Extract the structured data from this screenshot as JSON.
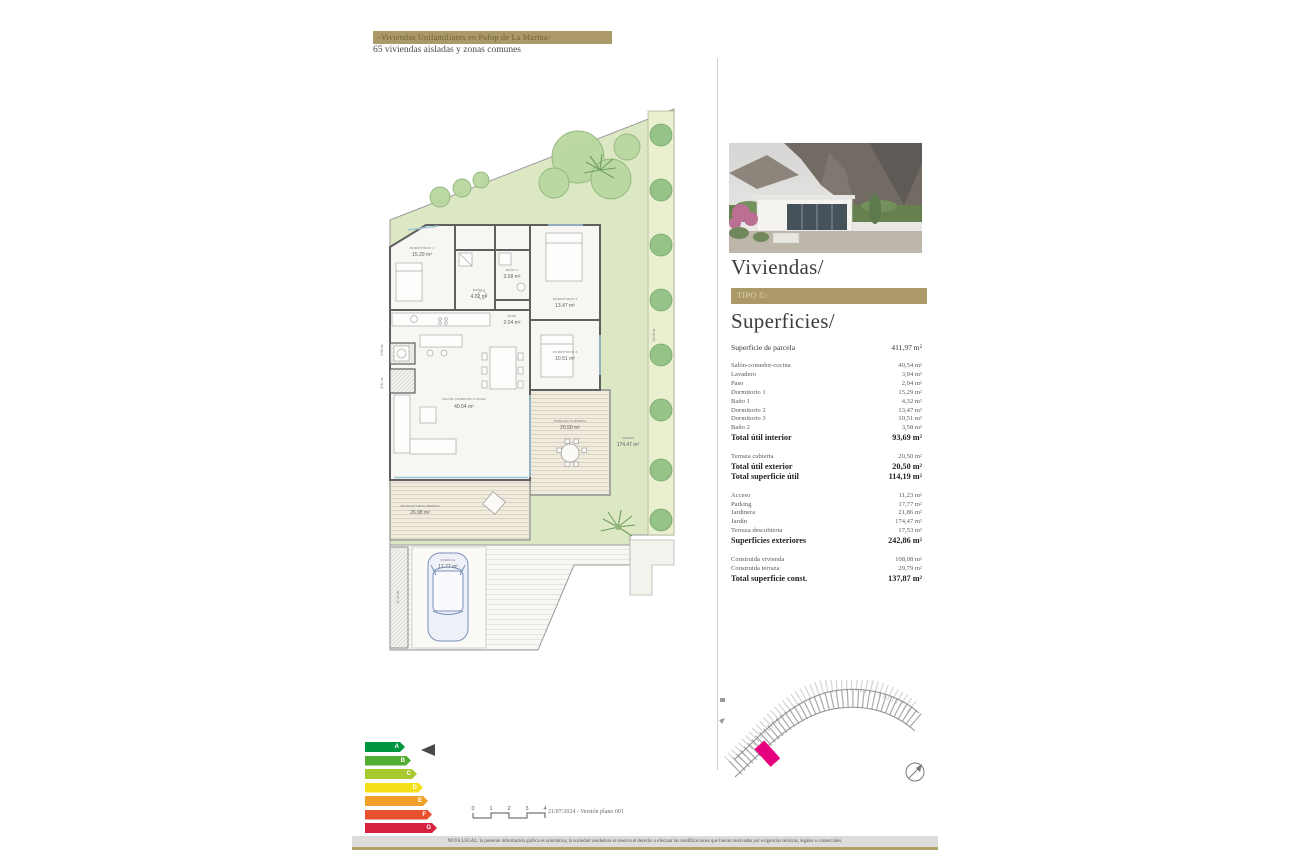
{
  "header": {
    "banner": "-Viviendas Unifamiliares en Polop de La Marina-",
    "subtitle": "65 viviendas aisladas y zonas comunes"
  },
  "panel": {
    "title": "Viviendas/",
    "type_banner": "TIPO G:",
    "subtitle": "Superficies/",
    "accent_color": "#ab9a68",
    "surfaces": {
      "groups": [
        [
          {
            "l": "Superficie de parcela",
            "v": "411,97 m²",
            "c": "m"
          }
        ],
        [
          {
            "l": "Salón-comedor-cocina",
            "v": "40,54 m²",
            "c": "s"
          },
          {
            "l": "Lavadero",
            "v": "3,94 m²",
            "c": "s"
          },
          {
            "l": "Paso",
            "v": "2,04 m²",
            "c": "s"
          },
          {
            "l": "Dormitorio 1",
            "v": "15,29 m²",
            "c": "s"
          },
          {
            "l": "Baño 1",
            "v": "4,32 m²",
            "c": "s"
          },
          {
            "l": "Dormitorio 2",
            "v": "13,47 m²",
            "c": "s"
          },
          {
            "l": "Dormitorio 3",
            "v": "10,51 m²",
            "c": "s"
          },
          {
            "l": "Baño 2",
            "v": "3,58 m²",
            "c": "s"
          },
          {
            "l": "Total útil interior",
            "v": "93,69 m²",
            "c": "t"
          }
        ],
        [
          {
            "l": "Terraza cubierta",
            "v": "20,50 m²",
            "c": "s"
          },
          {
            "l": "Total útil exterior",
            "v": "20,50 m²",
            "c": "t"
          },
          {
            "l": "Total superficie útil",
            "v": "114,19 m²",
            "c": "t"
          }
        ],
        [
          {
            "l": "Acceso",
            "v": "11,23 m²",
            "c": "s"
          },
          {
            "l": "Parking",
            "v": "17,77 m²",
            "c": "s"
          },
          {
            "l": "Jardinera",
            "v": "21,86 m²",
            "c": "s"
          },
          {
            "l": "Jardín",
            "v": "174,47 m²",
            "c": "s"
          },
          {
            "l": "Terraza descubierta",
            "v": "17,53 m²",
            "c": "s"
          },
          {
            "l": "Superficies exteriores",
            "v": "242,86 m²",
            "c": "t"
          }
        ],
        [
          {
            "l": "Construida vivienda",
            "v": "108,08 m²",
            "c": "s"
          },
          {
            "l": "Construida terraza",
            "v": "29,79 m²",
            "c": "s"
          },
          {
            "l": "Total superficie const.",
            "v": "137,87 m²",
            "c": "t"
          }
        ]
      ]
    }
  },
  "floorplan": {
    "rooms": {
      "dorm1": {
        "name": "DORMITORIO 1",
        "area": "15.29 m²"
      },
      "bano1": {
        "name": "BAÑO 1",
        "area": "4.32 m²"
      },
      "bano2": {
        "name": "BAÑO 2",
        "area": "3.58 m²"
      },
      "dorm2": {
        "name": "DORMITORIO 2",
        "area": "13.47 m²"
      },
      "paso": {
        "name": "PASO",
        "area": "2.04 m²"
      },
      "dorm3": {
        "name": "DORMITORIO 3",
        "area": "10.51 m²"
      },
      "lavadero": {
        "name": "LAVADERO",
        "area": "3.94 m²"
      },
      "salon": {
        "name": "SALÓN-COMEDOR-COCINA",
        "area": "40.54 m²"
      },
      "porche": {
        "name": "PORCHE",
        "area": "4.51 m²"
      },
      "terraza_cubierta": {
        "name": "TERRAZA CUBIERTA",
        "area": "20.50 m²"
      },
      "terraza_descubierta": {
        "name": "TERRAZA DESCUBIERTA",
        "area": "26.98 m²"
      },
      "acceso": {
        "name": "ACCESO",
        "area": "11.23 m²"
      },
      "parking": {
        "name": "PARKING",
        "area": "17.77 m²"
      },
      "jardin": {
        "name": "JARDÍN",
        "area": "174.47 m²"
      },
      "jardinera": {
        "name": "JARDINERA",
        "area": "14.08 m²"
      }
    }
  },
  "siteplan": {
    "highlight_color": "#e5007d"
  },
  "energy": {
    "ratings": [
      {
        "letter": "A",
        "color": "#009640"
      },
      {
        "letter": "B",
        "color": "#52ae32"
      },
      {
        "letter": "C",
        "color": "#a8c92f"
      },
      {
        "letter": "D",
        "color": "#f4e019"
      },
      {
        "letter": "E",
        "color": "#f0a02a"
      },
      {
        "letter": "F",
        "color": "#e8502e"
      },
      {
        "letter": "G",
        "color": "#d62240"
      }
    ]
  },
  "footer": {
    "scale_ticks": [
      "0",
      "1",
      "2",
      "3",
      "4"
    ],
    "version": "21/07/2024 - Versión plano 001",
    "legal": "NOTA LEGAL: la presente información gráfica es orientativa, la sociedad vendedora se reserva el derecho a efectuar las modificaciones que fueran motivadas por exigencias técnicas, legales o comerciales."
  }
}
